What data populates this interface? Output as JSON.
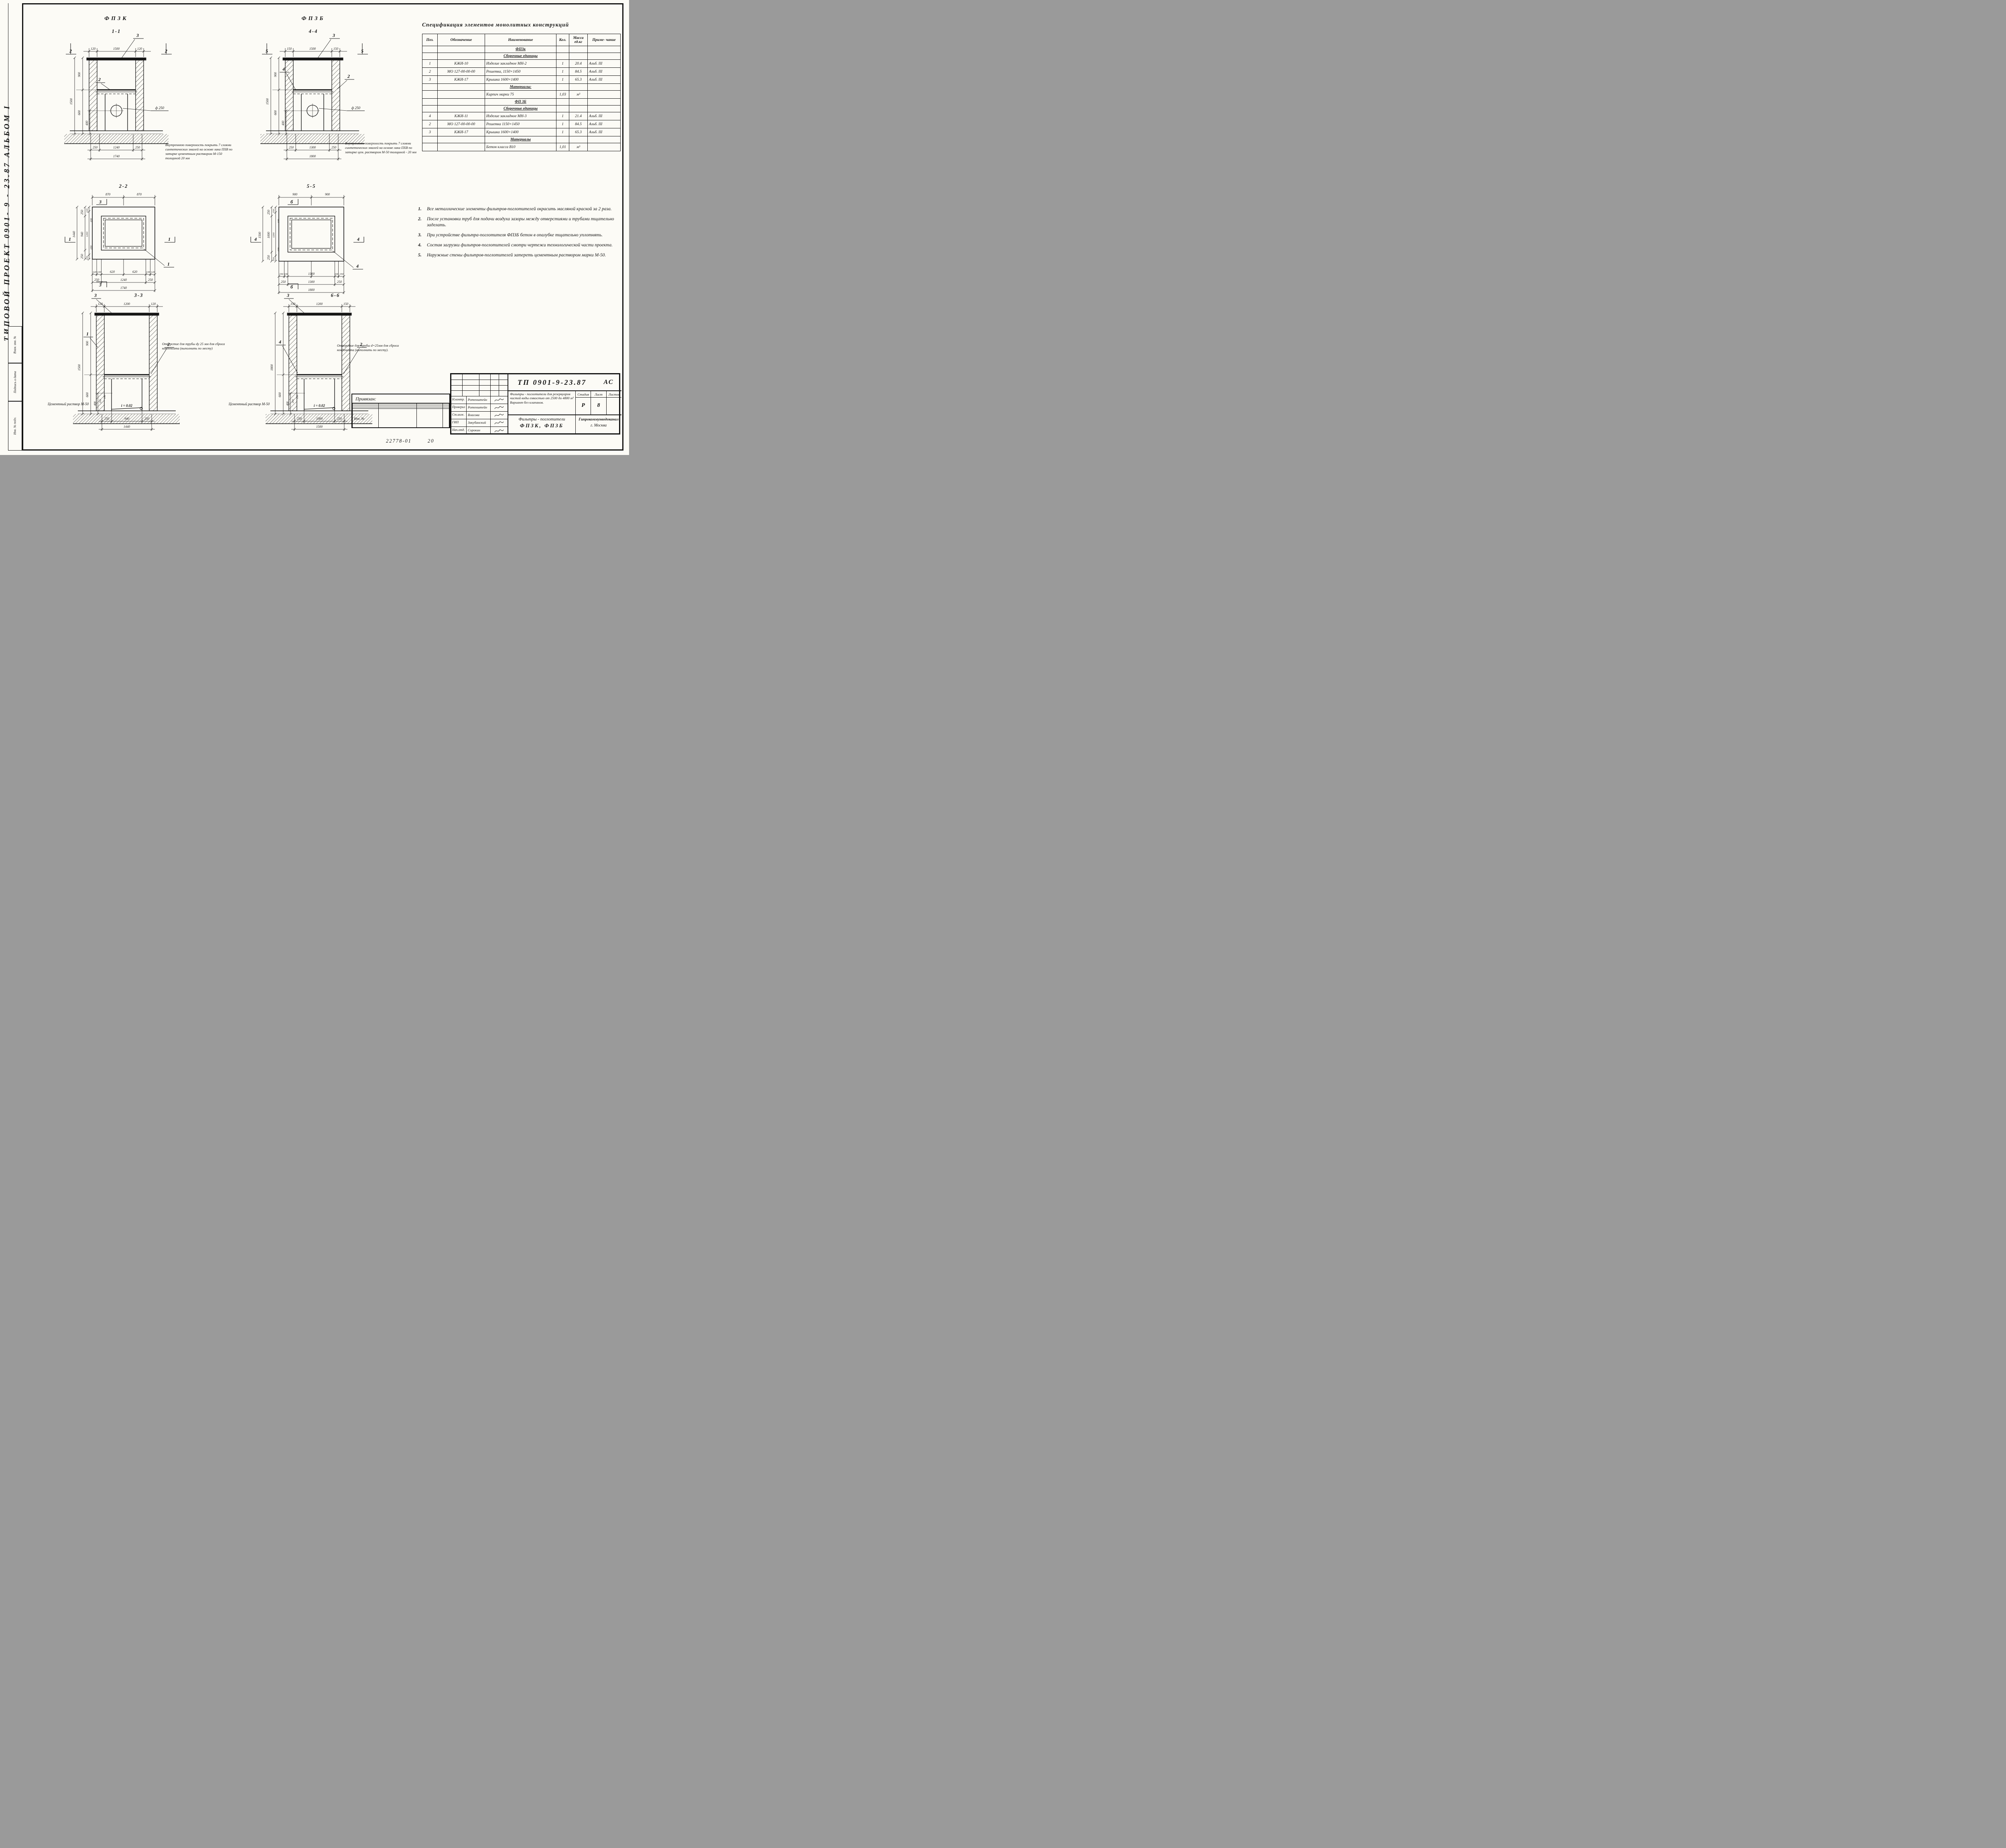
{
  "frame": {
    "side_text": "ТИПОВОЙ   ПРОЕКТ 0901- 9 - 23.87      АЛЬБОМ  I",
    "box_top": "Взам. инв. №",
    "box_mid": "Подпись и дата",
    "box_bot": "Инв. № подл.",
    "footer_code": "22778-01",
    "footer_page": "20"
  },
  "views": {
    "v11": {
      "title": "ФПЗК",
      "sec": "1-1",
      "t1": "120",
      "t2": "1500",
      "t3": "120",
      "lt": "1500",
      "l1": "900",
      "l2": "600",
      "l3": "400",
      "dia": "ф 250",
      "b1": "250",
      "b2": "1240",
      "b3": "250",
      "bt": "1740",
      "mk": "2",
      "c_top": "3",
      "c_a": "2",
      "note": "Внутреннюю поверхность покрыть 7 слоями синтетических эмалей на основе лака ПХВ по затирке цементным раствором М-150 толщиной 20 мм"
    },
    "v44": {
      "title": "ФПЗБ",
      "sec": "4-4",
      "t1": "150",
      "t2": "1500",
      "t3": "150",
      "lt": "1500",
      "l1": "900",
      "l2": "600",
      "l3": "400",
      "dia": "ф 250",
      "b1": "250",
      "b2": "1300",
      "b3": "250",
      "bt": "1800",
      "mk": "5",
      "c_top": "3",
      "c_a": "2",
      "c_b": "4",
      "note": "Внутреннюю поверхность покрыть 7 слоями синтетических эмалей на основе лака ПХВ по затирке цем. раствором М-50 толщиной - 20 мм"
    },
    "v22": {
      "sec": "2-2",
      "tl": "870",
      "tr": "870",
      "lt": "1440",
      "l1": "250",
      "l2": "940",
      "l3": "250",
      "li1": "120",
      "li2": "1200",
      "li3": "120",
      "s1": "130",
      "s2": "130",
      "b1": "120",
      "b2": "130",
      "b3": "620",
      "b4": "620",
      "b5": "130",
      "b6": "120",
      "c1": "250",
      "c2": "1240",
      "c3": "250",
      "tot": "1740",
      "mt": "3",
      "mb": "3",
      "ml": "1",
      "mr": "1",
      "co": "1"
    },
    "v55": {
      "sec": "5-5",
      "tl": "900",
      "tr": "900",
      "lt": "1500",
      "l1": "250",
      "l2": "1000",
      "l3": "250",
      "li1": "150",
      "li2": "1200",
      "li3": "150",
      "s1": "100",
      "s2": "100",
      "b1": "150",
      "b2": "100",
      "b3": "1300",
      "b4": "100",
      "b5": "150",
      "c1": "250",
      "c2": "1300",
      "c3": "250",
      "tot": "1800",
      "mt": "б",
      "mb": "б",
      "ml": "4",
      "mr": "4",
      "co": "4"
    },
    "v33": {
      "sec": "3-3",
      "t1": "120",
      "t2": "1200",
      "t3": "120",
      "lt": "1500",
      "l1": "900",
      "l2": "600",
      "l3": "400",
      "l4": "250",
      "l5": "150",
      "slope": "i = 0.02",
      "b1": "250",
      "b2": "940",
      "b3": "250",
      "bt": "1440",
      "c_top": "3",
      "c_a": "1",
      "c_b": "2",
      "note": "Отверстие для трубы dу 25 мм для сброса конденсата (выполнить по месту)",
      "mortar": "Цементный раствор М-50"
    },
    "v66": {
      "sec": "6-6",
      "t1": "150",
      "t2": "1200",
      "t3": "150",
      "lt": "1800",
      "l2": "600",
      "l3": "400",
      "l4": "250",
      "l5": "150",
      "slope": "i = 0.02",
      "b1": "250",
      "b2": "1000",
      "b3": "250",
      "bt": "1500",
      "c_top": "3",
      "c_a": "4",
      "c_b": "2",
      "note": "Отверстие для трубы d=25мм для сброса конденсата (выполнить по месту).",
      "mortar": "Цементный раствор М-50"
    }
  },
  "spec": {
    "title": "Спецификация элементов монолитных конструкций",
    "headers": {
      "pos": "Поз.",
      "mark": "Обозначение",
      "name": "Наименование",
      "qty": "Кол.",
      "mass": "Масса ед.кг",
      "note": "Приме- чание"
    },
    "rows": [
      {
        "kind": "group",
        "pos": "",
        "mark": "",
        "name": "ФПЗк",
        "qty": "",
        "mass": "",
        "note": ""
      },
      {
        "kind": "group",
        "pos": "",
        "mark": "",
        "name": "Сборочные единицы",
        "qty": "",
        "mass": "",
        "note": ""
      },
      {
        "kind": "item",
        "pos": "1",
        "mark": "КЖИ-10",
        "name": "Изделие закладное МН-2",
        "qty": "1",
        "mass": "20.4",
        "note": "Альб. III"
      },
      {
        "kind": "item",
        "pos": "2",
        "mark": "МО 127-00-00-00",
        "name": "Решетка, 1150×1450",
        "qty": "1",
        "mass": "84.5",
        "note": "Альб. III"
      },
      {
        "kind": "item",
        "pos": "3",
        "mark": "КЖИ-17",
        "name": "Крышка 1600×1400",
        "qty": "1",
        "mass": "65.3",
        "note": "Альб. III"
      },
      {
        "kind": "group",
        "pos": "",
        "mark": "",
        "name": "Материалы:",
        "qty": "",
        "mass": "",
        "note": ""
      },
      {
        "kind": "item",
        "pos": "",
        "mark": "",
        "name": "Кирпич марки 75",
        "qty": "1,03",
        "mass": "м³",
        "note": ""
      },
      {
        "kind": "group",
        "pos": "",
        "mark": "",
        "name": "ФП 3Б",
        "qty": "",
        "mass": "",
        "note": ""
      },
      {
        "kind": "group",
        "pos": "",
        "mark": "",
        "name": "Сборочные единицы",
        "qty": "",
        "mass": "",
        "note": ""
      },
      {
        "kind": "item",
        "pos": "4",
        "mark": "КЖИ-11",
        "name": "Изделие закладное МН-3",
        "qty": "1",
        "mass": "21.4",
        "note": "Альб. III"
      },
      {
        "kind": "item",
        "pos": "2",
        "mark": "МО 127-00-00-00",
        "name": "Решетка 1150×1450",
        "qty": "1",
        "mass": "84.5",
        "note": "Альб. III"
      },
      {
        "kind": "item",
        "pos": "3",
        "mark": "КЖИ-17",
        "name": "Крышка 1600×1400",
        "qty": "1",
        "mass": "65.3",
        "note": "Альб. III"
      },
      {
        "kind": "group",
        "pos": "",
        "mark": "",
        "name": "Материалы",
        "qty": "",
        "mass": "",
        "note": ""
      },
      {
        "kind": "item",
        "pos": "",
        "mark": "",
        "name": "Бетон класса В10",
        "qty": "1,01",
        "mass": "м³",
        "note": ""
      }
    ]
  },
  "notes": {
    "items": [
      {
        "n": "1.",
        "t": "Все металлические элементы фильтров-поглотителей окрасить масляной краской за 2 раза."
      },
      {
        "n": "2.",
        "t": "После установки труб для подачи воздуха зазоры между отверстиями и трубами тщательно заделать."
      },
      {
        "n": "3.",
        "t": "При устройстве фильтра-поглотителя ФПЗБ бетон в опалубке тщательно уплотнять."
      },
      {
        "n": "4.",
        "t": "Состав загрузки фильтров-поглотителей смотри чертежи технологической части проекта."
      },
      {
        "n": "5.",
        "t": "Наружные стены фильтров-поглотителей затереть цементным раствором марки М-50."
      }
    ]
  },
  "tb": {
    "attach": "Привязан:",
    "inv": "Инв. №",
    "doc": "ТП 0901-9-23.87",
    "type": "АС",
    "desc": "Фильтры - поглотители для резервуаров чистой воды емкостью от 2500 до 4800 м³ Вариант без клапанов.",
    "stage_h": "Стадия",
    "sheet_h": "Лист",
    "sheets_h": "Листов",
    "stage": "Р",
    "sheet": "8",
    "sheets": "",
    "name1": "Фильтры - поглотители",
    "name2": "ФПЗК, ФПЗБ",
    "org1": "Гипрокоммунводоканал",
    "org2": "г. Москва",
    "sig_rows": [
      {
        "r": "Н.контр.",
        "n": "Ротенштейн"
      },
      {
        "r": "Проверил",
        "n": "Ротенштейн"
      },
      {
        "r": "Ст.инж.",
        "n": "Власова"
      },
      {
        "r": "ГИП",
        "n": "Закубанский"
      },
      {
        "r": "Нач.отд.",
        "n": "Сорокин"
      }
    ]
  }
}
